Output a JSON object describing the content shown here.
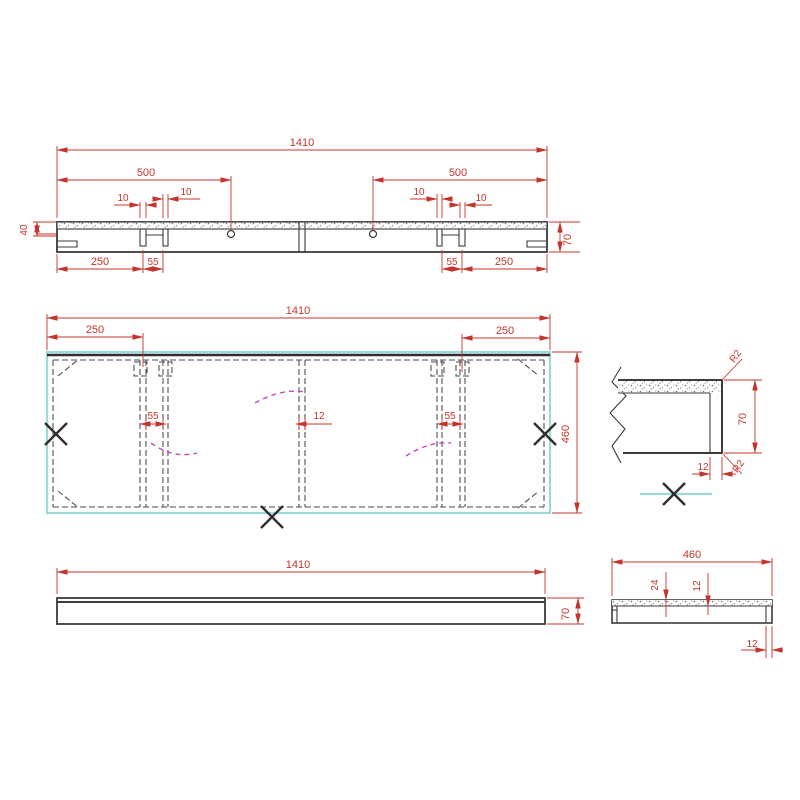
{
  "drawing": {
    "type": "cad-shelf-drawing",
    "colors": {
      "line": "#3b3b3b",
      "dimension_red": "#c4342c",
      "outline_cyan": "#9ed9d7",
      "bend_magenta": "#c04ec0",
      "background": "#ffffff"
    },
    "top_view": {
      "overall": "1410",
      "left_500": "500",
      "right_500": "500",
      "slot_a": "10",
      "slot_b": "10",
      "slot_c": "10",
      "slot_d": "10",
      "left_250": "250",
      "left_55": "55",
      "right_55": "55",
      "right_250": "250",
      "height_40": "40",
      "height_70": "70"
    },
    "plan_view": {
      "overall": "1410",
      "left_250": "250",
      "right_250": "250",
      "left_55": "55",
      "center_12": "12",
      "right_55": "55",
      "depth_460": "460"
    },
    "front_view": {
      "length": "1410",
      "height": "70"
    },
    "detail_view": {
      "radius_top": "R2",
      "radius_bottom": "R2",
      "height": "70",
      "thickness": "12"
    },
    "end_view": {
      "width": "460",
      "dim_24": "24",
      "dim_12": "12",
      "wall_12": "12"
    }
  }
}
